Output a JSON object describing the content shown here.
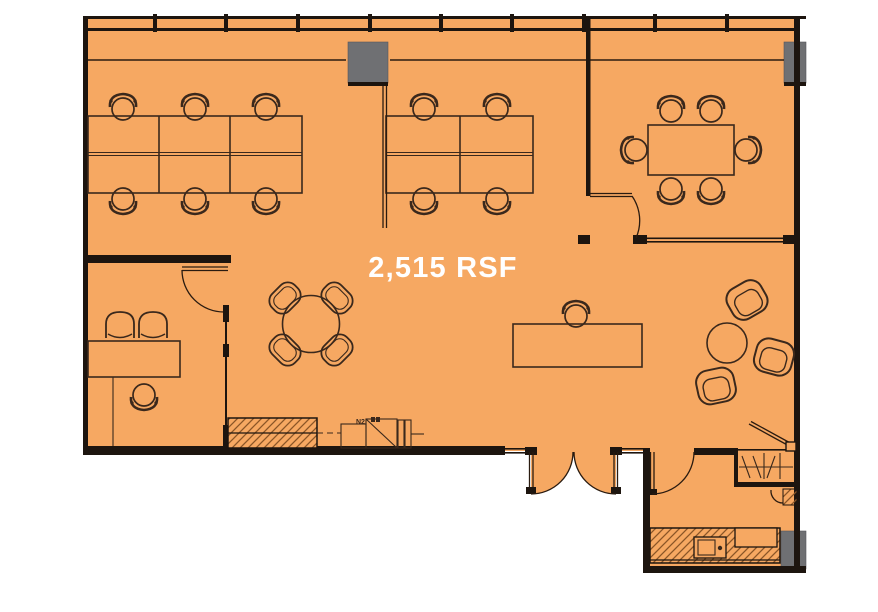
{
  "floorplan": {
    "area_label": "2,515 RSF",
    "equipment_label": "N2",
    "colors": {
      "background": "#FFFFFF",
      "floor": "#F6A862",
      "walls": "#1D150F",
      "columns": "#6F7073",
      "furniture": "#3A281C",
      "hatch": "#8A5526",
      "area_label_text": "#FFFFFF"
    }
  }
}
